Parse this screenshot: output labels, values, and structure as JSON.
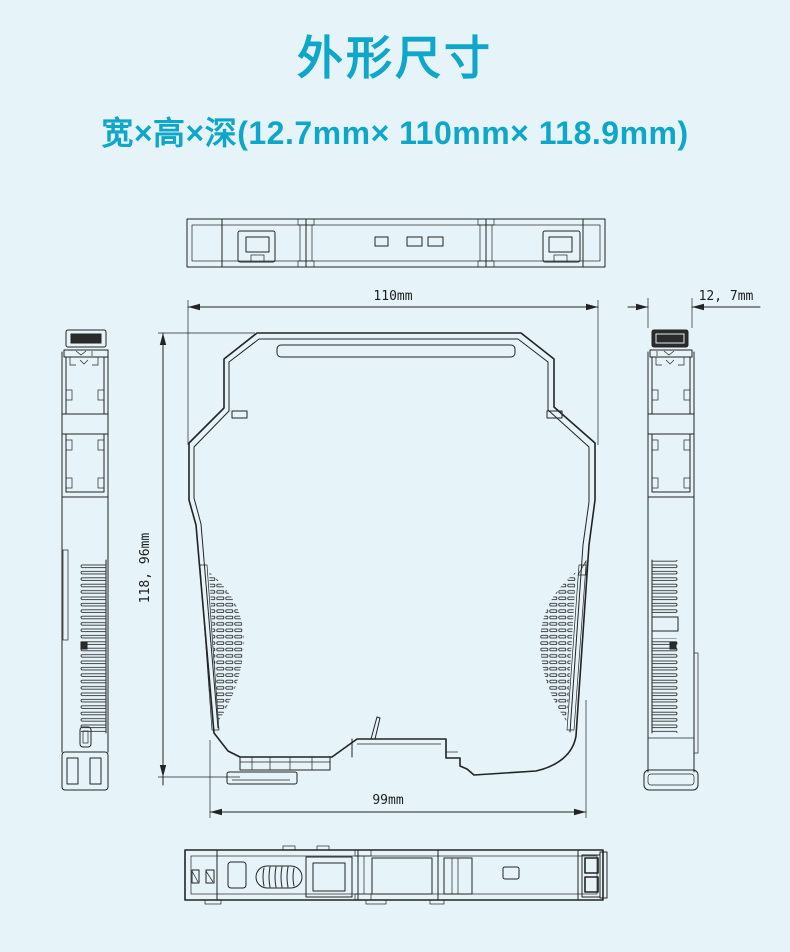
{
  "header": {
    "title": "外形尺寸",
    "subtitle": "宽×高×深(12.7mm× 110mm× 118.9mm)"
  },
  "drawing": {
    "dim_width_top": "110mm",
    "dim_height_left": "118, 96mm",
    "dim_bottom_width": "99mm",
    "dim_side_thickness": "12, 7mm"
  },
  "colors": {
    "accent": "#0ea7c9",
    "background": "#e6f4fa",
    "line": "#232323"
  }
}
